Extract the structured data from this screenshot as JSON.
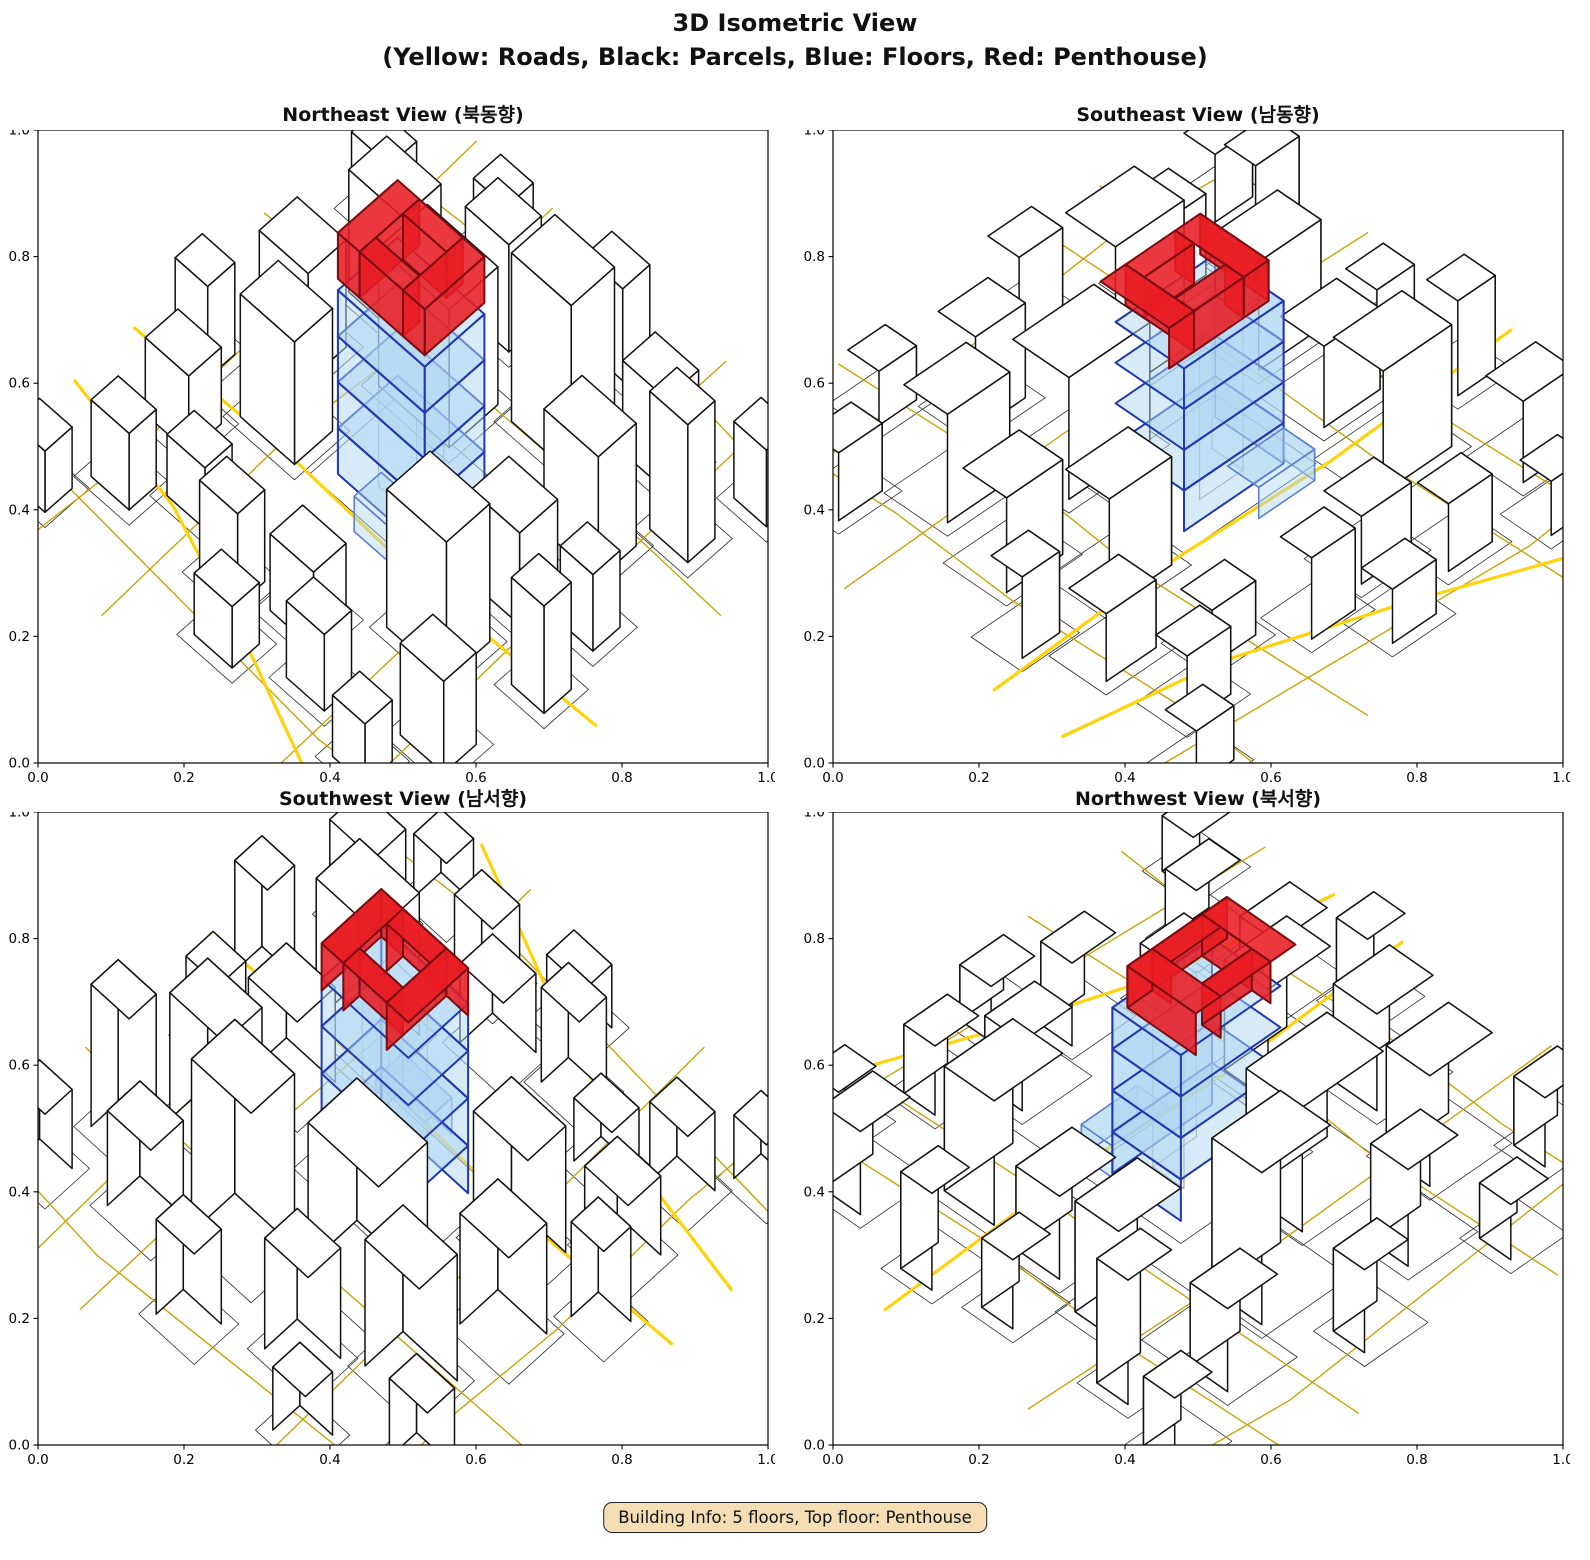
{
  "figure": {
    "title_line1": "3D Isometric View",
    "title_line2": "(Yellow: Roads, Black: Parcels, Blue: Floors, Red: Penthouse)",
    "caption": "Building Info: 5 floors, Top floor: Penthouse",
    "background": "#ffffff"
  },
  "chart_data": {
    "type": "3d-isometric-city",
    "title": "3D Isometric View",
    "legend": {
      "yellow": "Roads",
      "black": "Parcels",
      "blue": "Floors",
      "red": "Penthouse"
    },
    "building_info": {
      "total_floors": 5,
      "top_floor": "Penthouse",
      "regular_floors": 4
    },
    "axis": {
      "range": [
        0.0,
        1.0
      ],
      "ticks": [
        "0.0",
        "0.2",
        "0.4",
        "0.6",
        "0.8",
        "1.0"
      ]
    },
    "views": [
      {
        "label": "Northeast View (북동향)",
        "rotation_deg": 0
      },
      {
        "label": "Southeast View (남동향)",
        "rotation_deg": 90
      },
      {
        "label": "Southwest View (남서향)",
        "rotation_deg": 180
      },
      {
        "label": "Northwest View (북서향)",
        "rotation_deg": 270
      }
    ],
    "colors": {
      "road_major": "#ffd20a",
      "road_minor": "#c8a40a",
      "parcel_line": "#2a2a2a",
      "building_fill": "#ffffff",
      "building_edge": "#111111",
      "floor_fill": "#aed6f1",
      "floor_edge": "#2038b0",
      "annex_edge": "#5c7fd0",
      "core_edge": "#999999",
      "penthouse_fill": "#e81c23",
      "penthouse_edge": "#7a0c10",
      "caption_bg": "#f5deb3"
    },
    "parcel_inflation": 1.6,
    "white_buildings": [
      [
        -7,
        -12,
        13,
        9,
        9
      ],
      [
        8,
        -20,
        11,
        8,
        11
      ],
      [
        22,
        -11,
        10,
        7,
        8
      ],
      [
        -21,
        -18,
        10,
        7,
        8
      ],
      [
        -9,
        -26,
        8,
        6,
        7
      ],
      [
        20,
        -26,
        8,
        6,
        6
      ],
      [
        -25,
        -5,
        9,
        7,
        7
      ],
      [
        -18,
        5,
        10,
        7,
        8
      ],
      [
        -28,
        14,
        8,
        6,
        5
      ],
      [
        20,
        1,
        9,
        7,
        6
      ],
      [
        30,
        -20,
        7,
        5,
        9
      ],
      [
        31,
        -2,
        6,
        5,
        5
      ],
      [
        18,
        13,
        11,
        8,
        9
      ],
      [
        29,
        24,
        8,
        6,
        6
      ],
      [
        4,
        23,
        8,
        6,
        5
      ],
      [
        -7,
        26,
        7,
        5,
        6
      ],
      [
        -18,
        21,
        7,
        5,
        4
      ],
      [
        12,
        29,
        7,
        5,
        5
      ],
      [
        -27,
        26,
        7,
        5,
        5
      ],
      [
        -1,
        33,
        7,
        5,
        4
      ],
      [
        24,
        33,
        6,
        5,
        4
      ],
      [
        -33,
        5,
        6,
        5,
        6
      ],
      [
        33,
        9,
        6,
        5,
        7
      ],
      [
        -31,
        -26,
        7,
        5,
        5
      ],
      [
        5,
        -33,
        7,
        5,
        6
      ],
      [
        -17,
        -34,
        6,
        5,
        4
      ],
      [
        34,
        -31,
        6,
        5,
        5
      ],
      [
        -34,
        34,
        6,
        5,
        4
      ]
    ],
    "roads": {
      "major": [
        [
          [
            -42,
            9
          ],
          [
            -14,
            8
          ],
          [
            12,
            9
          ],
          [
            42,
            8
          ]
        ],
        [
          [
            -42,
            20
          ],
          [
            -20,
            24
          ],
          [
            2,
            32
          ],
          [
            26,
            42
          ]
        ]
      ],
      "minor": [
        [
          [
            -16,
            -42
          ],
          [
            -15,
            -12
          ],
          [
            -16.5,
            6
          ],
          [
            -15,
            42
          ]
        ],
        [
          [
            16,
            -42
          ],
          [
            16.5,
            -6
          ],
          [
            16,
            12
          ],
          [
            17,
            42
          ]
        ],
        [
          [
            -42,
            -15
          ],
          [
            -18,
            -15.5
          ],
          [
            10,
            -16
          ],
          [
            42,
            -15
          ]
        ],
        [
          [
            -42,
            -31
          ],
          [
            -10,
            -33
          ],
          [
            20,
            -35
          ],
          [
            42,
            -33
          ]
        ],
        [
          [
            26,
            -42
          ],
          [
            27,
            -12
          ],
          [
            26,
            8
          ],
          [
            27.5,
            42
          ]
        ],
        [
          [
            -30,
            -42
          ],
          [
            -29,
            -20
          ],
          [
            -30,
            0
          ],
          [
            -29,
            25
          ],
          [
            -30,
            42
          ]
        ],
        [
          [
            -42,
            31
          ],
          [
            -12,
            33
          ],
          [
            18,
            35
          ],
          [
            42,
            33
          ]
        ]
      ]
    },
    "center_building": {
      "x": 0,
      "y": 0,
      "width": 16,
      "depth": 11,
      "floors": 4,
      "floor_height": 3,
      "core": {
        "x": 0.5,
        "y": 0.5,
        "w": 7,
        "d": 5,
        "h": 12
      },
      "annex": {
        "x": 4,
        "y": 7.5,
        "w": 9,
        "d": 5,
        "h": 2.3
      },
      "penthouse": {
        "z": 12,
        "height": 3,
        "outer": {
          "x": -1.2,
          "y": -1.2,
          "width": 16,
          "depth": 11
        },
        "hole": {
          "width": 8,
          "depth": 5
        }
      }
    }
  }
}
